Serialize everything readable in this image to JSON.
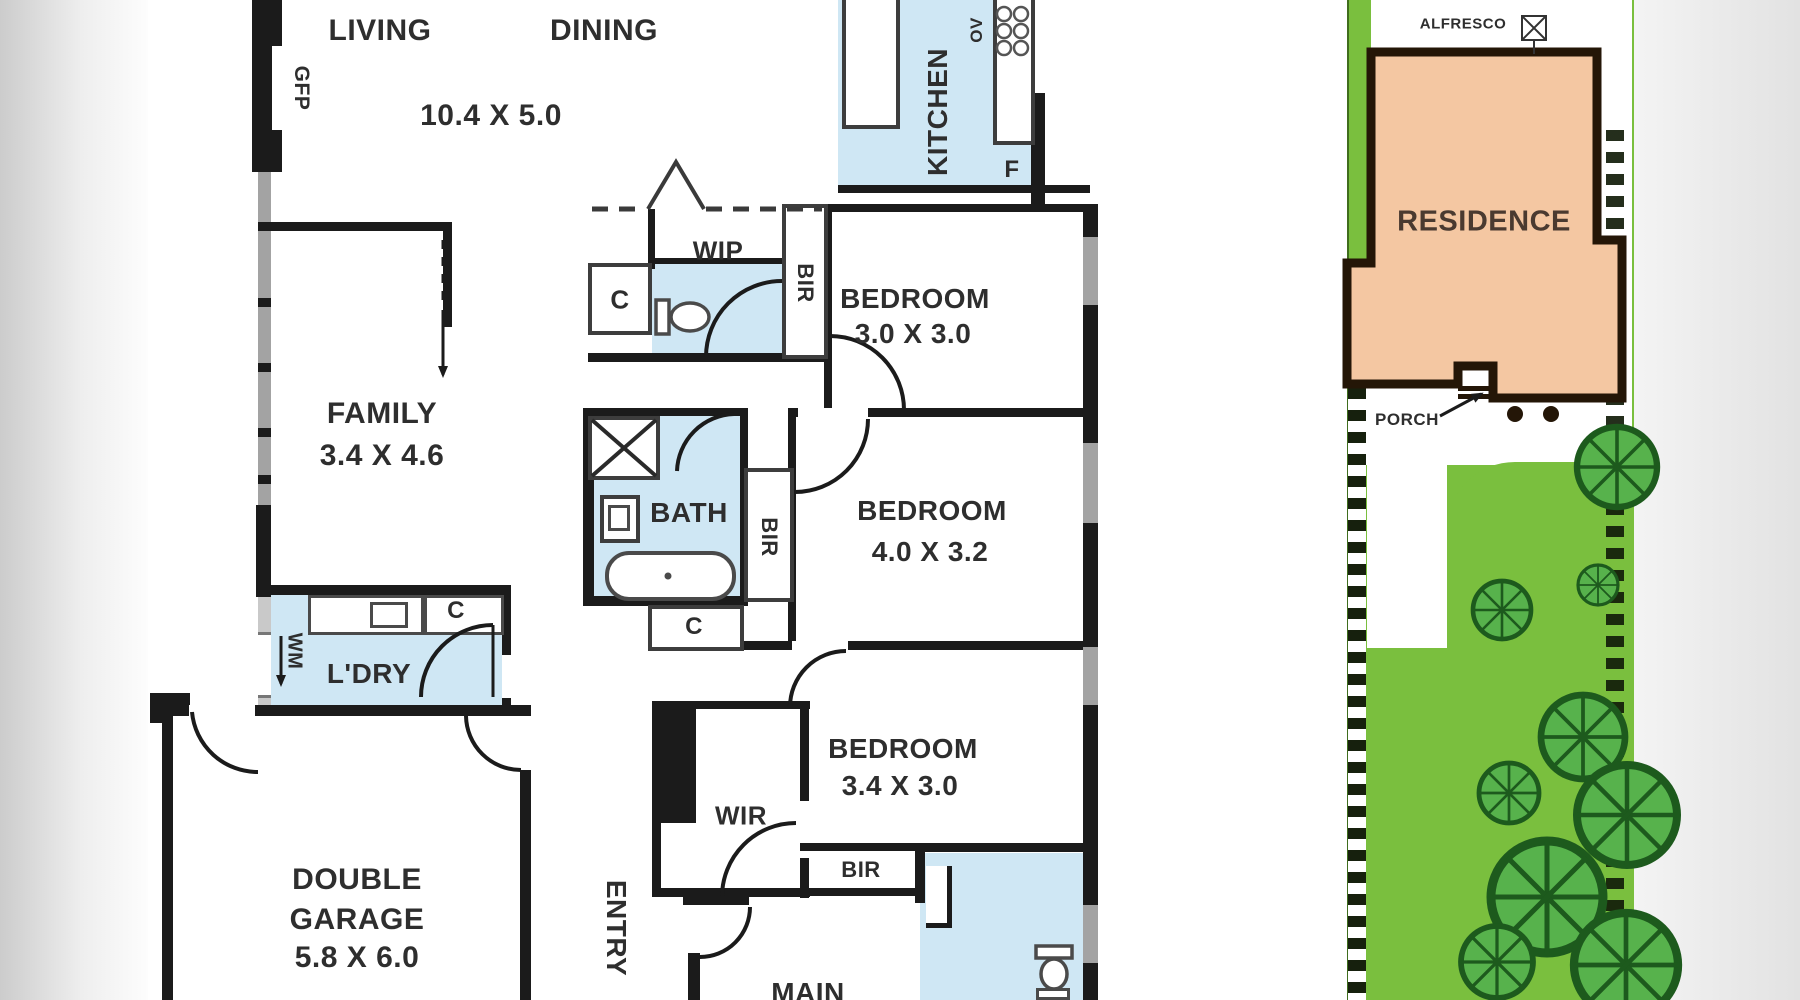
{
  "colors": {
    "wall": "#1b1b1b",
    "wet_area": "#cfe7f4",
    "window_gray": "#a3a3a3",
    "lot_green": "#7abf3e",
    "tree_green": "#57b24c",
    "tree_outline": "#1d5a1d",
    "residence_fill": "#f4c7a2",
    "residence_border": "#241607",
    "label_text": "#2e2e2e"
  },
  "floorplan": {
    "living": {
      "label": "LIVING"
    },
    "dining": {
      "label": "DINING"
    },
    "living_dining_dims": "10.4 X 5.0",
    "kitchen": {
      "label": "KITCHEN",
      "oven": "OV",
      "fridge": "F"
    },
    "gfp": "GFP",
    "wip": {
      "label": "WIP"
    },
    "bedroom1": {
      "label": "BEDROOM",
      "dims": "3.0 X 3.0"
    },
    "family": {
      "label": "FAMILY",
      "dims": "3.4 X 4.6"
    },
    "bath": {
      "label": "BATH"
    },
    "bedroom2": {
      "label": "BEDROOM",
      "dims": "4.0 X 3.2"
    },
    "laundry": {
      "label": "L'DRY",
      "washing_machine": "WM"
    },
    "garage": {
      "line1": "DOUBLE",
      "line2": "GARAGE",
      "dims": "5.8 X 6.0"
    },
    "entry": {
      "label": "ENTRY"
    },
    "wir": {
      "label": "WIR"
    },
    "bedroom3": {
      "label": "BEDROOM",
      "dims": "3.4 X 3.0"
    },
    "main": {
      "label": "MAIN"
    },
    "cupboard": "C",
    "robe": "BIR"
  },
  "siteplan": {
    "alfresco": "ALFRESCO",
    "residence": "RESIDENCE",
    "porch": "PORCH"
  }
}
